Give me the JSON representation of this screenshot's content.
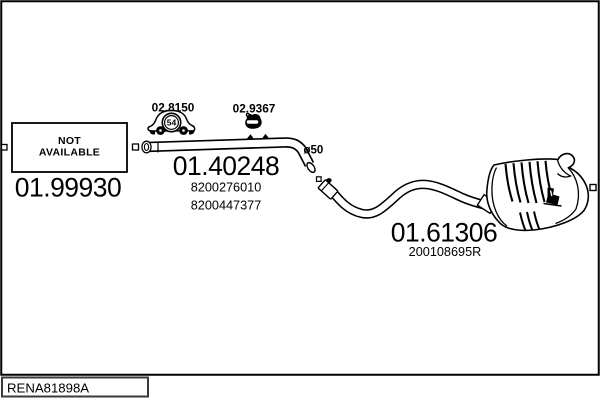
{
  "drawing_code": "RENA81898A",
  "colors": {
    "line": "#000000",
    "background": "#ffffff"
  },
  "parts": {
    "front_section": {
      "status_line1": "NOT",
      "status_line2": "AVAILABLE",
      "part_number": "01.99930"
    },
    "middle_pipe": {
      "part_number": "01.40248",
      "oe_refs": [
        "8200276010",
        "8200447377"
      ],
      "diameter_label": "ø50"
    },
    "rear_silencer": {
      "part_number": "01.61306",
      "oe_ref": "200108695R"
    }
  },
  "accessories": [
    {
      "code": "02.8150",
      "icon": "rubber-mount-car-icon",
      "badge": "54"
    },
    {
      "code": "02.9367",
      "icon": "exhaust-clamp-icon"
    }
  ]
}
